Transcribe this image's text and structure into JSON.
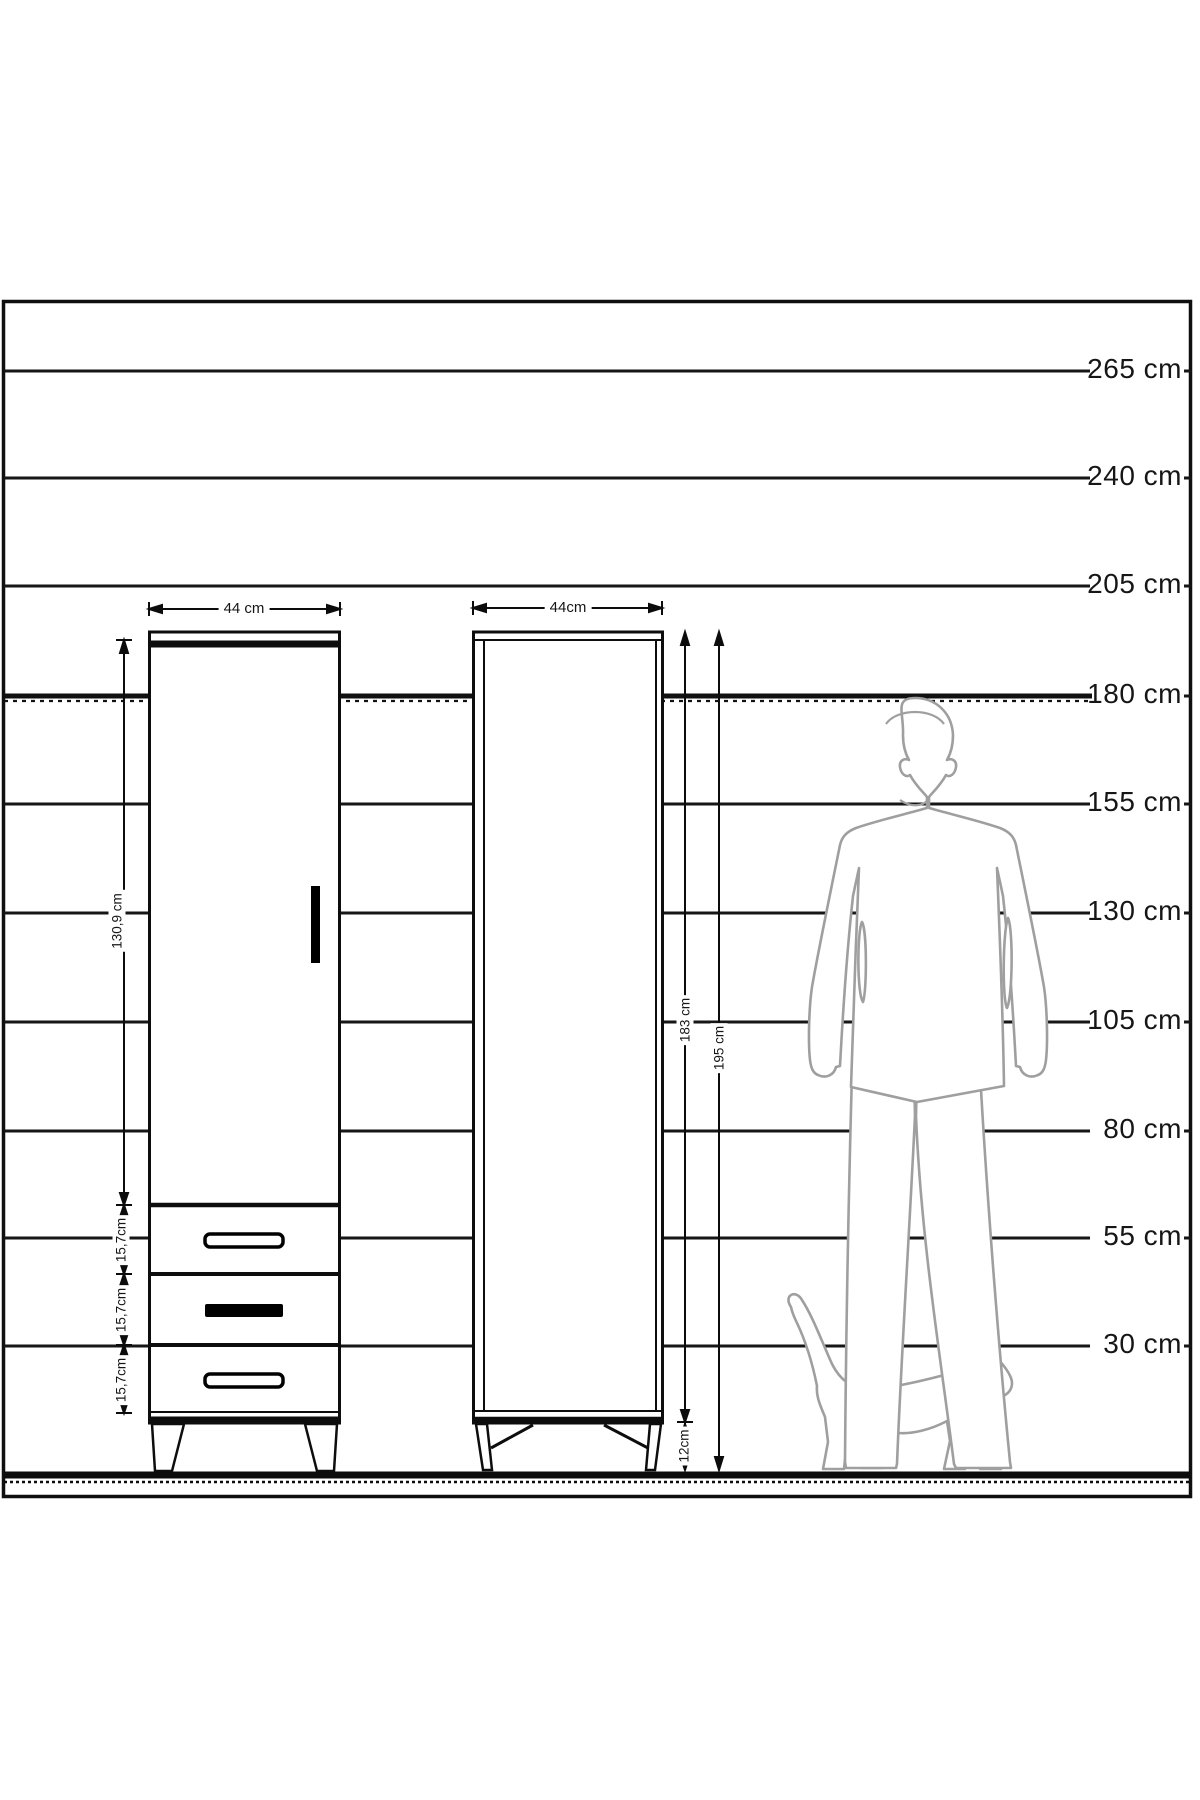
{
  "diagram": {
    "title_hint": "wardrobe height comparison drawing",
    "ruler": {
      "unit": "cm",
      "labels": [
        "265 cm",
        "240 cm",
        "205 cm",
        "180 cm",
        "155 cm",
        "130 cm",
        "105 cm",
        "80 cm",
        "55 cm",
        "30 cm"
      ]
    },
    "left_cabinet": {
      "name": "wardrobe front view with door and 3 drawers",
      "width_label": "44 cm",
      "door_height_label": "130,9 cm",
      "drawer_labels": [
        "15,7cm",
        "15,7cm",
        "15,7cm"
      ]
    },
    "right_cabinet": {
      "name": "wardrobe side view",
      "width_label": "44cm",
      "body_height_label": "183 cm",
      "total_height_label": "195 cm",
      "leg_height_label": "12cm"
    },
    "figures": {
      "man": "adult man silhouette, 180 cm tall",
      "cat": "walking cat silhouette at floor level"
    },
    "colors": {
      "line": "#141414",
      "silhouette_outline": "#9f9f9f",
      "background": "#ffffff"
    }
  }
}
